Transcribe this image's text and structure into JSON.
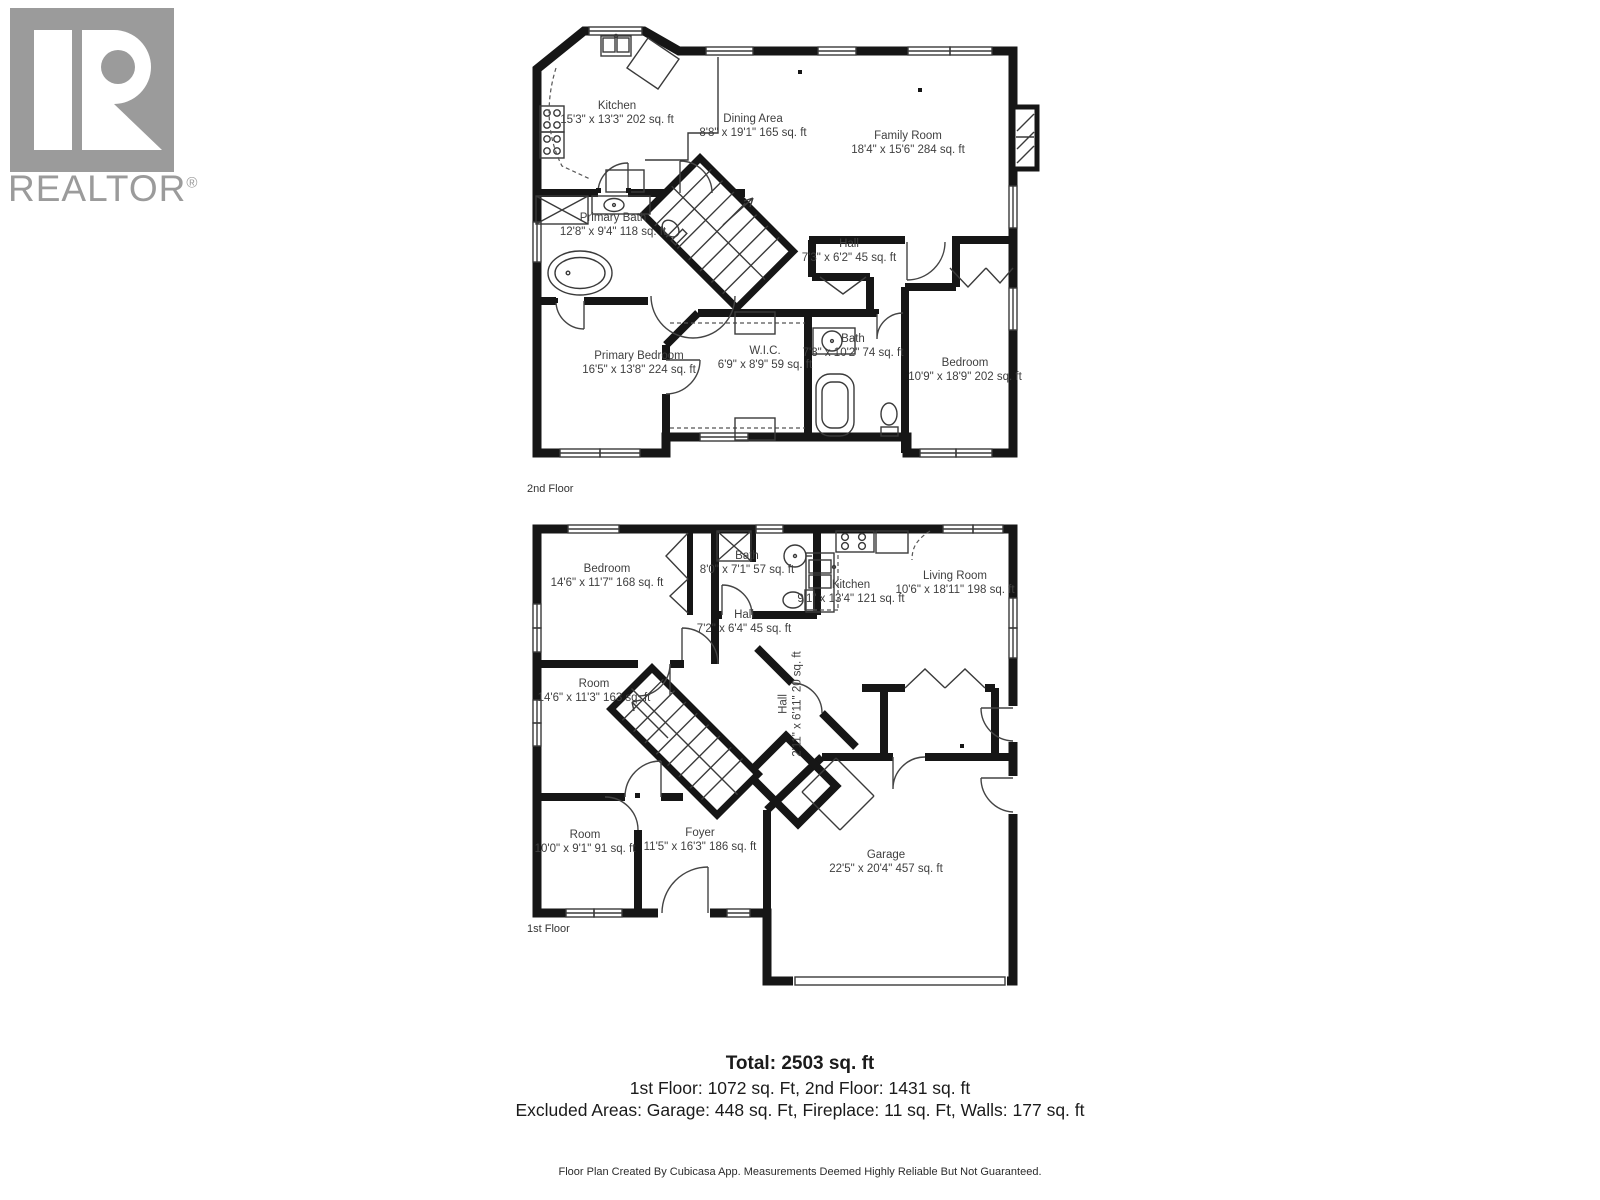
{
  "logo": {
    "brand": "REALTOR",
    "registered": "®"
  },
  "floors": [
    {
      "label": "2nd Floor",
      "rooms": [
        {
          "name": "Kitchen",
          "dims": "15'3\" x 13'3\" 202 sq. ft"
        },
        {
          "name": "Dining Area",
          "dims": "8'8\" x 19'1\" 165 sq. ft"
        },
        {
          "name": "Family Room",
          "dims": "18'4\" x 15'6\" 284 sq. ft"
        },
        {
          "name": "Primary Bath",
          "dims": "12'8\" x 9'4\" 118 sq. ft"
        },
        {
          "name": "Hall",
          "dims": "7'3\" x 6'2\" 45 sq. ft"
        },
        {
          "name": "Primary Bedroom",
          "dims": "16'5\" x 13'8\" 224 sq. ft"
        },
        {
          "name": "W.I.C.",
          "dims": "6'9\" x 8'9\" 59 sq. ft"
        },
        {
          "name": "Bath",
          "dims": "7'3\" x 10'2\" 74 sq. ft"
        },
        {
          "name": "Bedroom",
          "dims": "10'9\" x 18'9\" 202 sq. ft"
        }
      ]
    },
    {
      "label": "1st Floor",
      "rooms": [
        {
          "name": "Bedroom",
          "dims": "14'6\" x 11'7\" 168 sq. ft"
        },
        {
          "name": "Bath",
          "dims": "8'0\" x 7'1\" 57 sq. ft"
        },
        {
          "name": "Kitchen",
          "dims": "9'1\" x 13'4\" 121 sq. ft"
        },
        {
          "name": "Living Room",
          "dims": "10'6\" x 18'11\" 198 sq. ft"
        },
        {
          "name": "Hall",
          "dims": "7'2\" x 6'4\" 45 sq. ft"
        },
        {
          "name": "Room",
          "dims": "14'6\" x 11'3\" 163 sq. ft"
        },
        {
          "name": "Hall",
          "dims": "2'11\" x 6'11\" 20 sq. ft"
        },
        {
          "name": "Room",
          "dims": "10'0\" x 9'1\" 91 sq. ft"
        },
        {
          "name": "Foyer",
          "dims": "11'5\" x 16'3\" 186 sq. ft"
        },
        {
          "name": "Garage",
          "dims": "22'5\" x 20'4\" 457 sq. ft"
        }
      ]
    }
  ],
  "summary": {
    "total": "Total: 2503 sq. ft",
    "floors_line": "1st Floor: 1072 sq. Ft, 2nd Floor: 1431 sq. ft",
    "excluded_line": "Excluded Areas: Garage: 448 sq. Ft, Fireplace: 11 sq. Ft, Walls: 177 sq. ft"
  },
  "footer": "Floor Plan Created By Cubicasa App. Measurements Deemed Highly Reliable But Not Guaranteed."
}
